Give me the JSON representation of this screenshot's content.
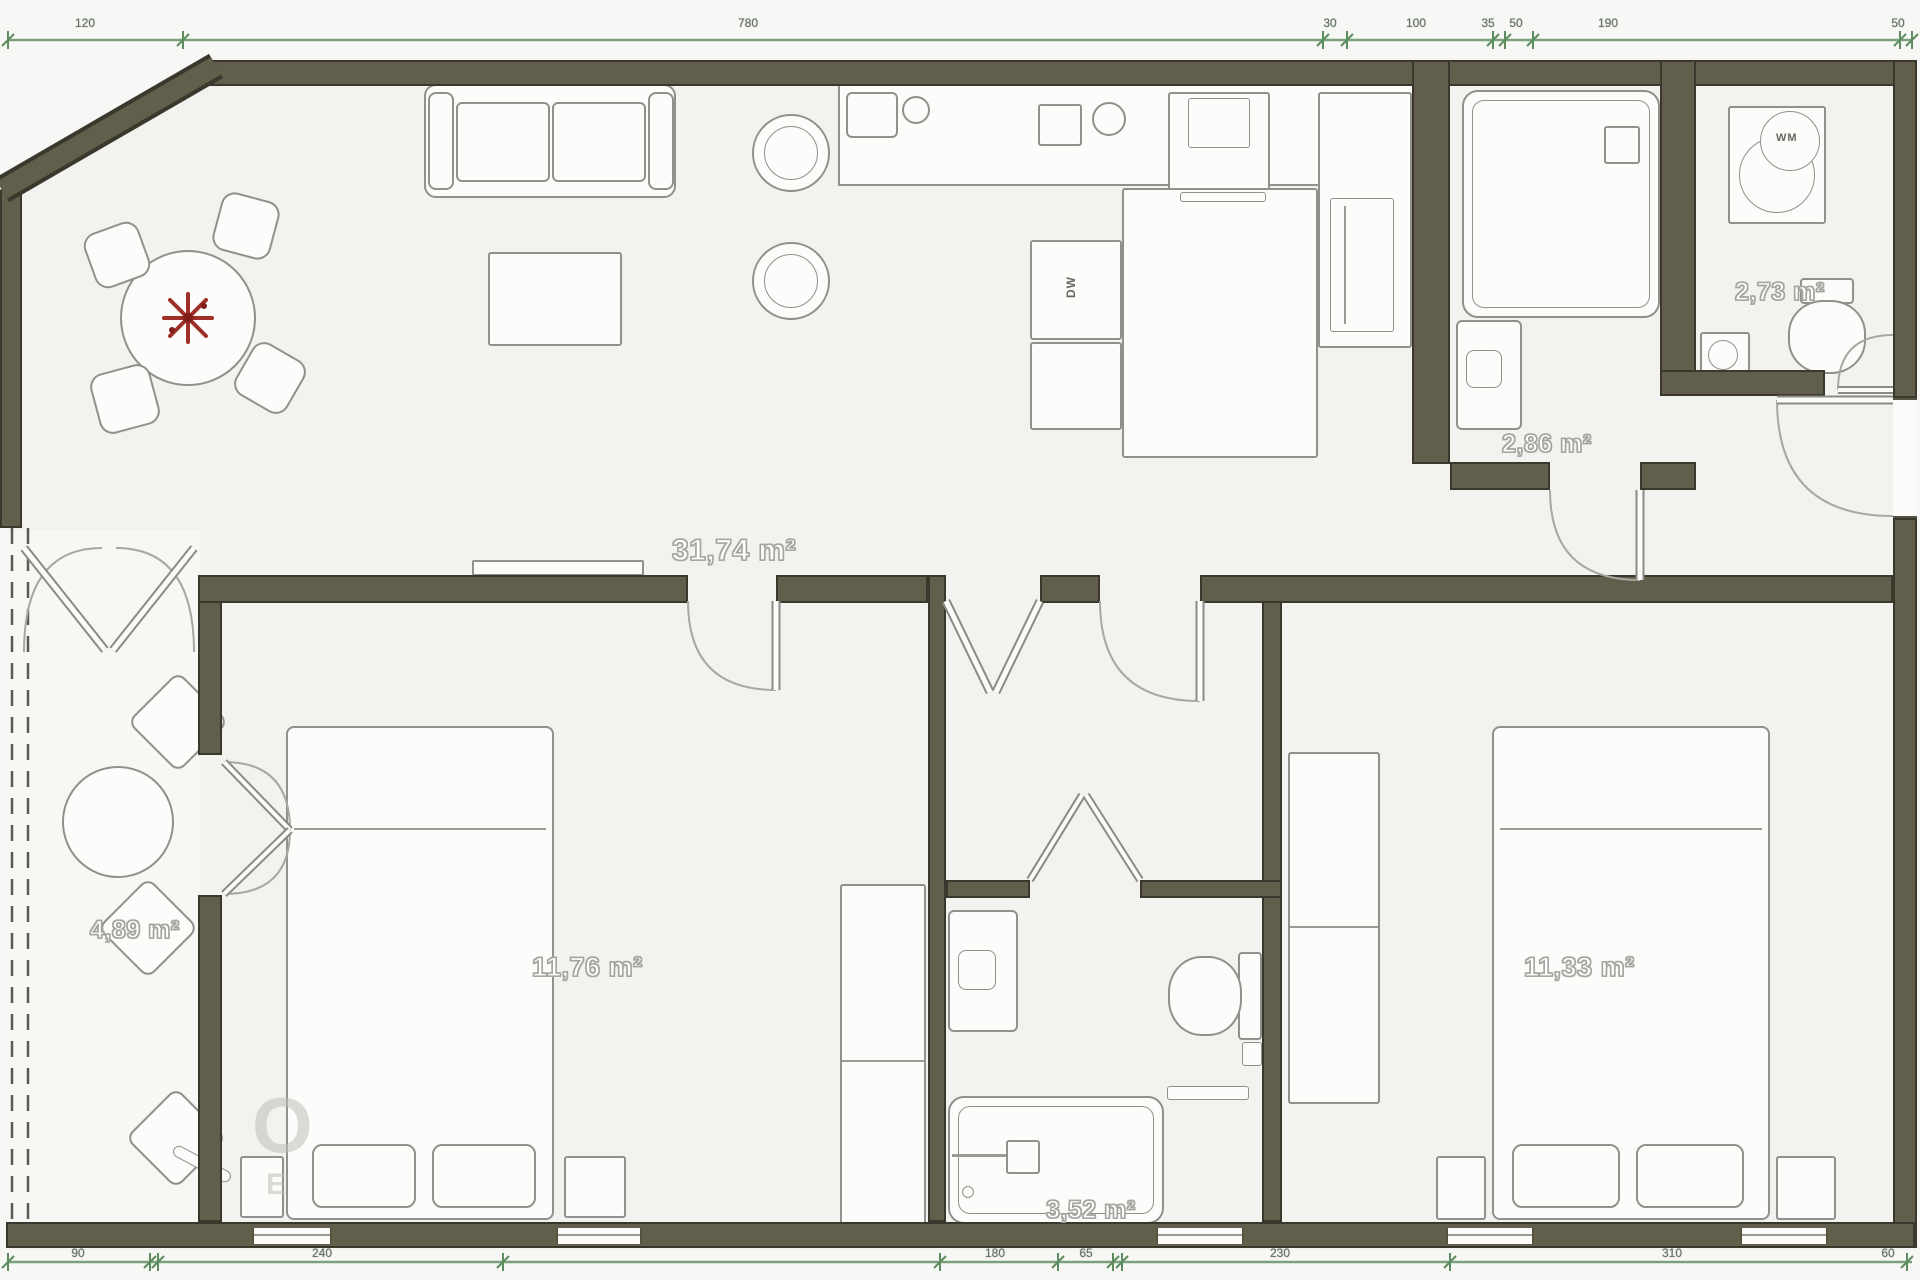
{
  "plan_title": "apartment floor plan",
  "rooms": [
    {
      "name": "living-kitchen",
      "area": "31,74 m²"
    },
    {
      "name": "bathroom",
      "area": "2,86 m²"
    },
    {
      "name": "wc",
      "area": "2,73 m²"
    },
    {
      "name": "bedroom-1",
      "area": "11,76 m²"
    },
    {
      "name": "bedroom-2",
      "area": "11,33 m²"
    },
    {
      "name": "balcony",
      "area": "4,89 m²"
    },
    {
      "name": "bathroom-2",
      "area": "3,52 m²"
    }
  ],
  "appliances": {
    "dishwasher": "DW",
    "washing_machine": "WM"
  },
  "dimensions": {
    "top": [
      "120",
      "780",
      "30",
      "100",
      "35",
      "50",
      "190",
      "50"
    ],
    "bottom": [
      "90",
      "240",
      "180",
      "65",
      "230",
      "310",
      "60"
    ]
  },
  "watermark": {
    "letter_o": "O",
    "letter_e": "E"
  },
  "colors": {
    "wall": "#615e4c",
    "wall_edge": "#3a382c",
    "floor": "#f2f2ef",
    "furniture_outline": "#90908c",
    "dimension_line": "#5d8c5f",
    "area_label": "#ffffff",
    "flower": "#9e2f28"
  }
}
